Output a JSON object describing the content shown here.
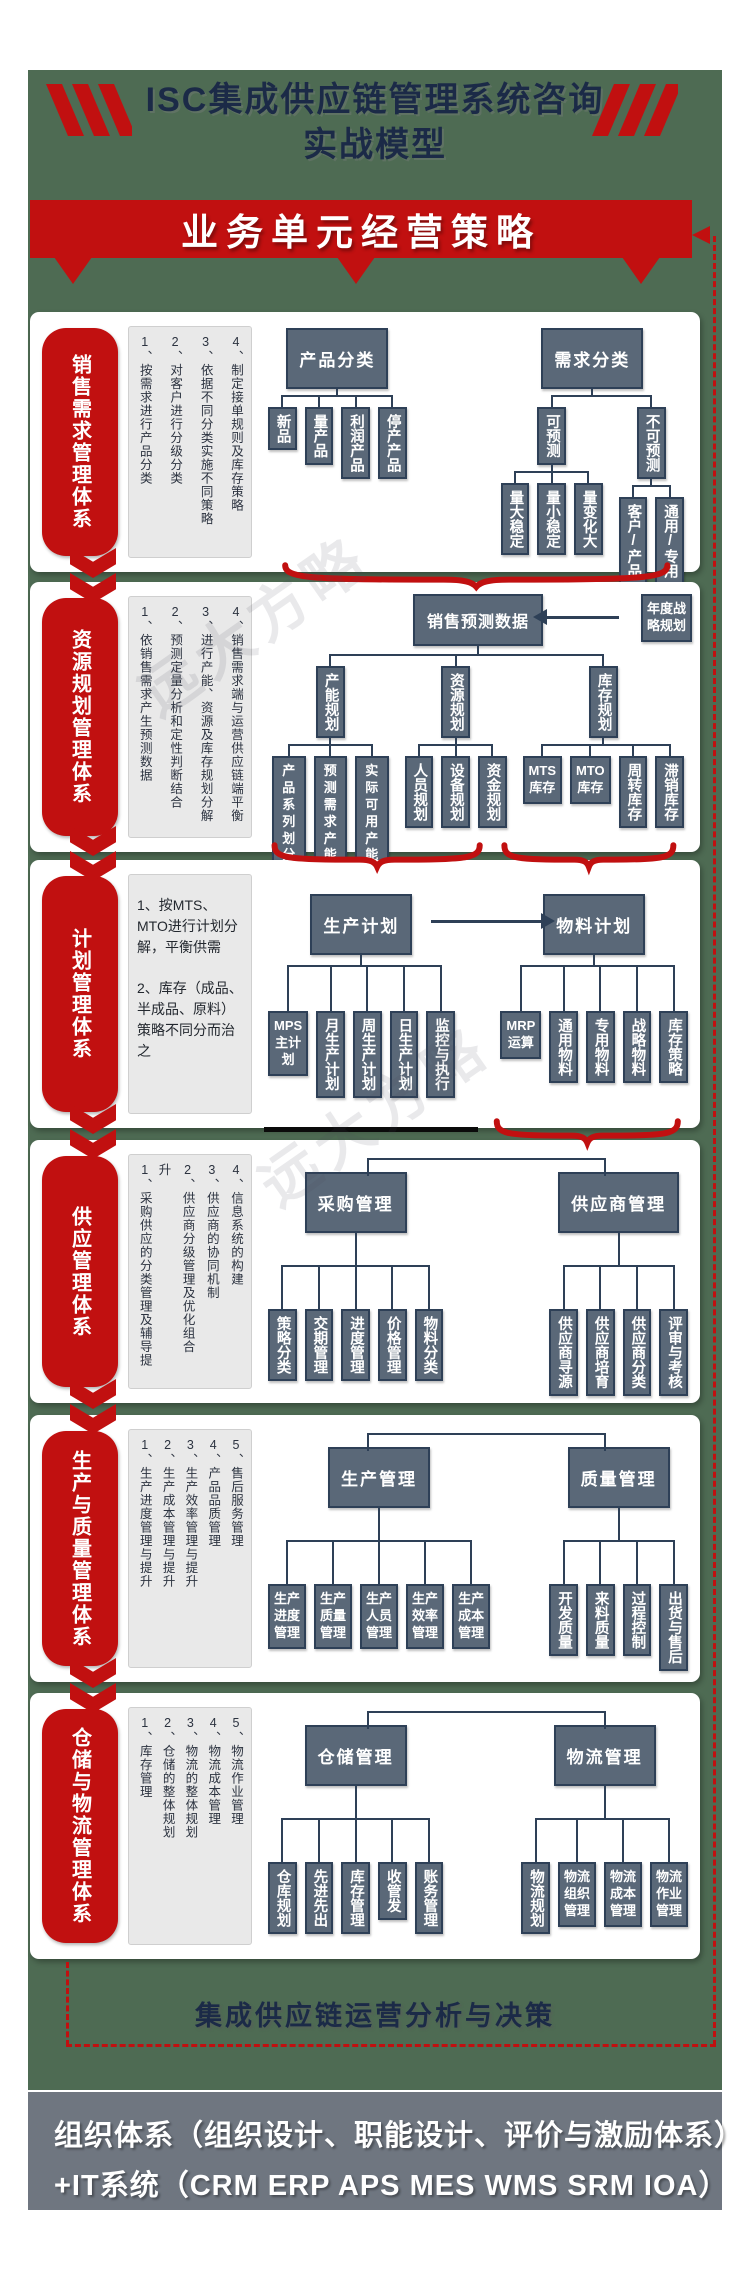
{
  "header": {
    "title_line1": "ISC集成供应链管理系统咨询",
    "title_line2": "实战模型"
  },
  "banner": {
    "label": "业务单元经营策略"
  },
  "watermark_text": "远大方略",
  "analysis_bar": {
    "label": "集成供应链运营分析与决策"
  },
  "footer": {
    "line1": "组织体系（组织设计、职能设计、评价与激励体系）",
    "line2": "+IT系统（CRM ERP APS MES WMS SRM IOA）"
  },
  "colors": {
    "green_bg": "#4e6b53",
    "red": "#c11010",
    "navy_text": "#1b2a47",
    "line": "#2e4057",
    "box_fill": "#5a6878",
    "note_bg": "#e9e9e9",
    "footer_bg": "#6f7680"
  },
  "sections": [
    {
      "id": "sales-demand",
      "label": "销售需求管理体系",
      "notes": {
        "style": "columns",
        "items": [
          "1、按需求进行产品分类",
          "2、对客户进行分级分类",
          "3、依据不同分类实施不同策略",
          "4、制定接单规则及库存策略"
        ]
      },
      "trees": [
        {
          "t": "产品分类",
          "m": "H",
          "kids": [
            {
              "t": "新品",
              "m": "v"
            },
            {
              "t": "量产品",
              "m": "v"
            },
            {
              "t": "利润产品",
              "m": "v"
            },
            {
              "t": "停产产品",
              "m": "v"
            }
          ]
        },
        {
          "t": "需求分类",
          "m": "H",
          "kids": [
            {
              "t": "可预测",
              "m": "v",
              "kids": [
                {
                  "t": "量大稳定",
                  "m": "v"
                },
                {
                  "t": "量小稳定",
                  "m": "v"
                },
                {
                  "t": "量变化大",
                  "m": "v"
                }
              ]
            },
            {
              "t": "不可预测",
              "m": "v",
              "kids": [
                {
                  "t": "客户/产品",
                  "m": "v"
                },
                {
                  "t": "通用/专用",
                  "m": "v"
                }
              ]
            }
          ]
        }
      ]
    },
    {
      "id": "resource-planning",
      "label": "资源规划管理体系",
      "notes": {
        "style": "columns",
        "items": [
          "1、依销售需求产生预测数据",
          "2、预测定量分析和定性判断结合",
          "3、进行产能、资源及库存规划分解",
          "4、销售需求端与运营供应链端平衡"
        ]
      },
      "side_box": "年度战\n略规划",
      "trees": [
        {
          "t": "销售预测数据",
          "m": "h",
          "kids": [
            {
              "t": "产能规划",
              "m": "v",
              "kids": [
                {
                  "t": "产品\n系列\n划分",
                  "m": "w"
                },
                {
                  "t": "预测\n需求\n产能",
                  "m": "w"
                },
                {
                  "t": "实际\n可用\n产能",
                  "m": "w"
                }
              ]
            },
            {
              "t": "资源规划",
              "m": "v",
              "kids": [
                {
                  "t": "人员规划",
                  "m": "v"
                },
                {
                  "t": "设备规划",
                  "m": "v"
                },
                {
                  "t": "资金规划",
                  "m": "v"
                }
              ]
            },
            {
              "t": "库存规划",
              "m": "v",
              "kids": [
                {
                  "t": "MTS\n库存",
                  "m": "w"
                },
                {
                  "t": "MTO\n库存",
                  "m": "w"
                },
                {
                  "t": "周转库存",
                  "m": "v"
                },
                {
                  "t": "滞销库存",
                  "m": "v"
                }
              ]
            }
          ]
        }
      ]
    },
    {
      "id": "planning",
      "label": "计划管理体系",
      "notes": {
        "style": "lines",
        "items": [
          "1、按MTS、MTO进行计划分解，平衡供需",
          "2、库存（成品、半成品、原料）策略不同分而治之"
        ]
      },
      "trees": [
        {
          "t": "生产计划",
          "m": "H",
          "kids": [
            {
              "t": "MPS\n主计\n划",
              "m": "w"
            },
            {
              "t": "月生产计划",
              "m": "v"
            },
            {
              "t": "周生产计划",
              "m": "v"
            },
            {
              "t": "日生产计划",
              "m": "v"
            },
            {
              "t": "监控与执行",
              "m": "v"
            }
          ]
        },
        {
          "t": "物料计划",
          "m": "H",
          "kids": [
            {
              "t": "MRP\n运算",
              "m": "w"
            },
            {
              "t": "通用物料",
              "m": "v"
            },
            {
              "t": "专用物料",
              "m": "v"
            },
            {
              "t": "战略物料",
              "m": "v"
            },
            {
              "t": "库存策略",
              "m": "v"
            }
          ]
        }
      ]
    },
    {
      "id": "supply",
      "label": "供应管理体系",
      "notes": {
        "style": "columns",
        "items": [
          "1、采购供应的分类管理及辅导提升",
          "2、供应商分级管理及优化组合",
          "3、供应商的协同机制",
          "4、信息系统的构建"
        ]
      },
      "trees": [
        {
          "t": "采购管理",
          "m": "H",
          "kids": [
            {
              "t": "策略分类",
              "m": "v"
            },
            {
              "t": "交期管理",
              "m": "v"
            },
            {
              "t": "进度管理",
              "m": "v"
            },
            {
              "t": "价格管理",
              "m": "v"
            },
            {
              "t": "物料分类",
              "m": "v"
            }
          ]
        },
        {
          "t": "供应商管理",
          "m": "H",
          "kids": [
            {
              "t": "供应商寻源",
              "m": "v"
            },
            {
              "t": "供应商培育",
              "m": "v"
            },
            {
              "t": "供应商分类",
              "m": "v"
            },
            {
              "t": "评审与考核",
              "m": "v"
            }
          ]
        }
      ]
    },
    {
      "id": "production-quality",
      "label": "生产与质量管理体系",
      "notes": {
        "style": "columns",
        "items": [
          "1、生产进度管理与提升",
          "2、生产成本管理与提升",
          "3、生产效率管理与提升",
          "4、产品品质管理",
          "5、售后服务管理"
        ]
      },
      "trees": [
        {
          "t": "生产管理",
          "m": "H",
          "kids": [
            {
              "t": "生产\n进度\n管理",
              "m": "w"
            },
            {
              "t": "生产\n质量\n管理",
              "m": "w"
            },
            {
              "t": "生产\n人员\n管理",
              "m": "w"
            },
            {
              "t": "生产\n效率\n管理",
              "m": "w"
            },
            {
              "t": "生产\n成本\n管理",
              "m": "w"
            }
          ]
        },
        {
          "t": "质量管理",
          "m": "H",
          "kids": [
            {
              "t": "开发质量",
              "m": "v"
            },
            {
              "t": "来料质量",
              "m": "v"
            },
            {
              "t": "过程控制",
              "m": "v"
            },
            {
              "t": "出货与售后",
              "m": "v"
            }
          ]
        }
      ]
    },
    {
      "id": "warehouse-logistics",
      "label": "仓储与物流管理体系",
      "notes": {
        "style": "columns",
        "items": [
          "1、库存管理",
          "2、仓储的整体规划",
          "3、物流的整体规划",
          "4、物流成本管理",
          "5、物流作业管理"
        ]
      },
      "trees": [
        {
          "t": "仓储管理",
          "m": "H",
          "kids": [
            {
              "t": "仓库规划",
              "m": "v"
            },
            {
              "t": "先进先出",
              "m": "v"
            },
            {
              "t": "库存管理",
              "m": "v"
            },
            {
              "t": "收管发",
              "m": "v"
            },
            {
              "t": "账务管理",
              "m": "v"
            }
          ]
        },
        {
          "t": "物流管理",
          "m": "H",
          "kids": [
            {
              "t": "物流规划",
              "m": "v"
            },
            {
              "t": "物流\n组织\n管理",
              "m": "w"
            },
            {
              "t": "物流\n成本\n管理",
              "m": "w"
            },
            {
              "t": "物流\n作业\n管理",
              "m": "w"
            }
          ]
        }
      ]
    }
  ]
}
